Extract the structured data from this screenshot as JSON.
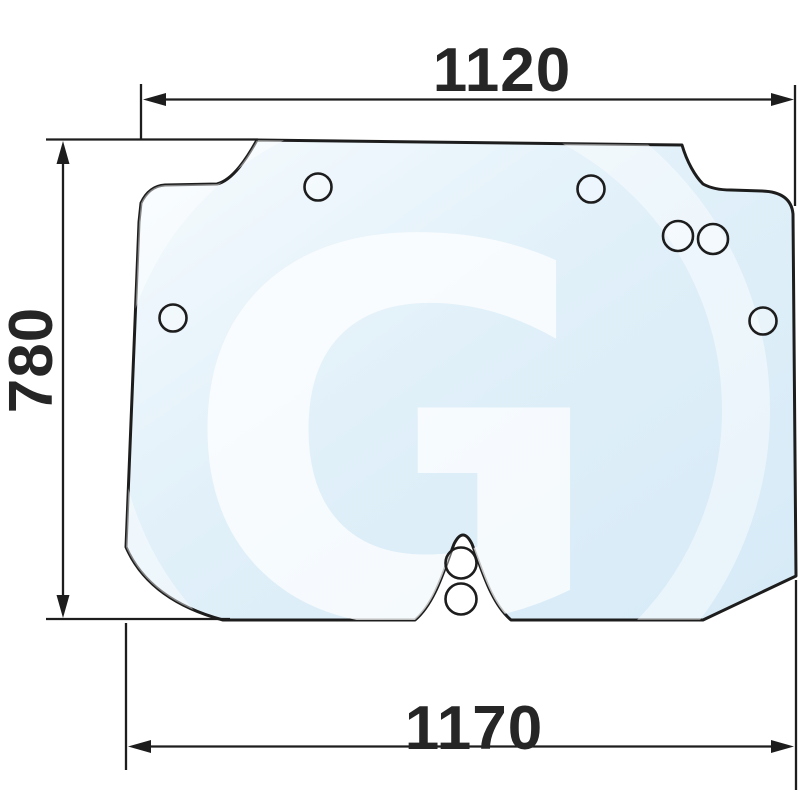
{
  "drawing": {
    "description": "Technical dimensional drawing of a tractor cab glass panel with mounting holes",
    "watermark_letter": "G",
    "dimension_labels": {
      "top_width": "1120",
      "left_height": "780",
      "bottom_width": "1170"
    },
    "holes_count": 8,
    "colors": {
      "background": "#ffffff",
      "line": "#1d1d1d",
      "text": "#262626",
      "glass_light": "#f6fbfe",
      "glass_mid": "#e1f0f9",
      "glass_deep": "#d6eaf7",
      "watermark": "#ffffff"
    }
  }
}
